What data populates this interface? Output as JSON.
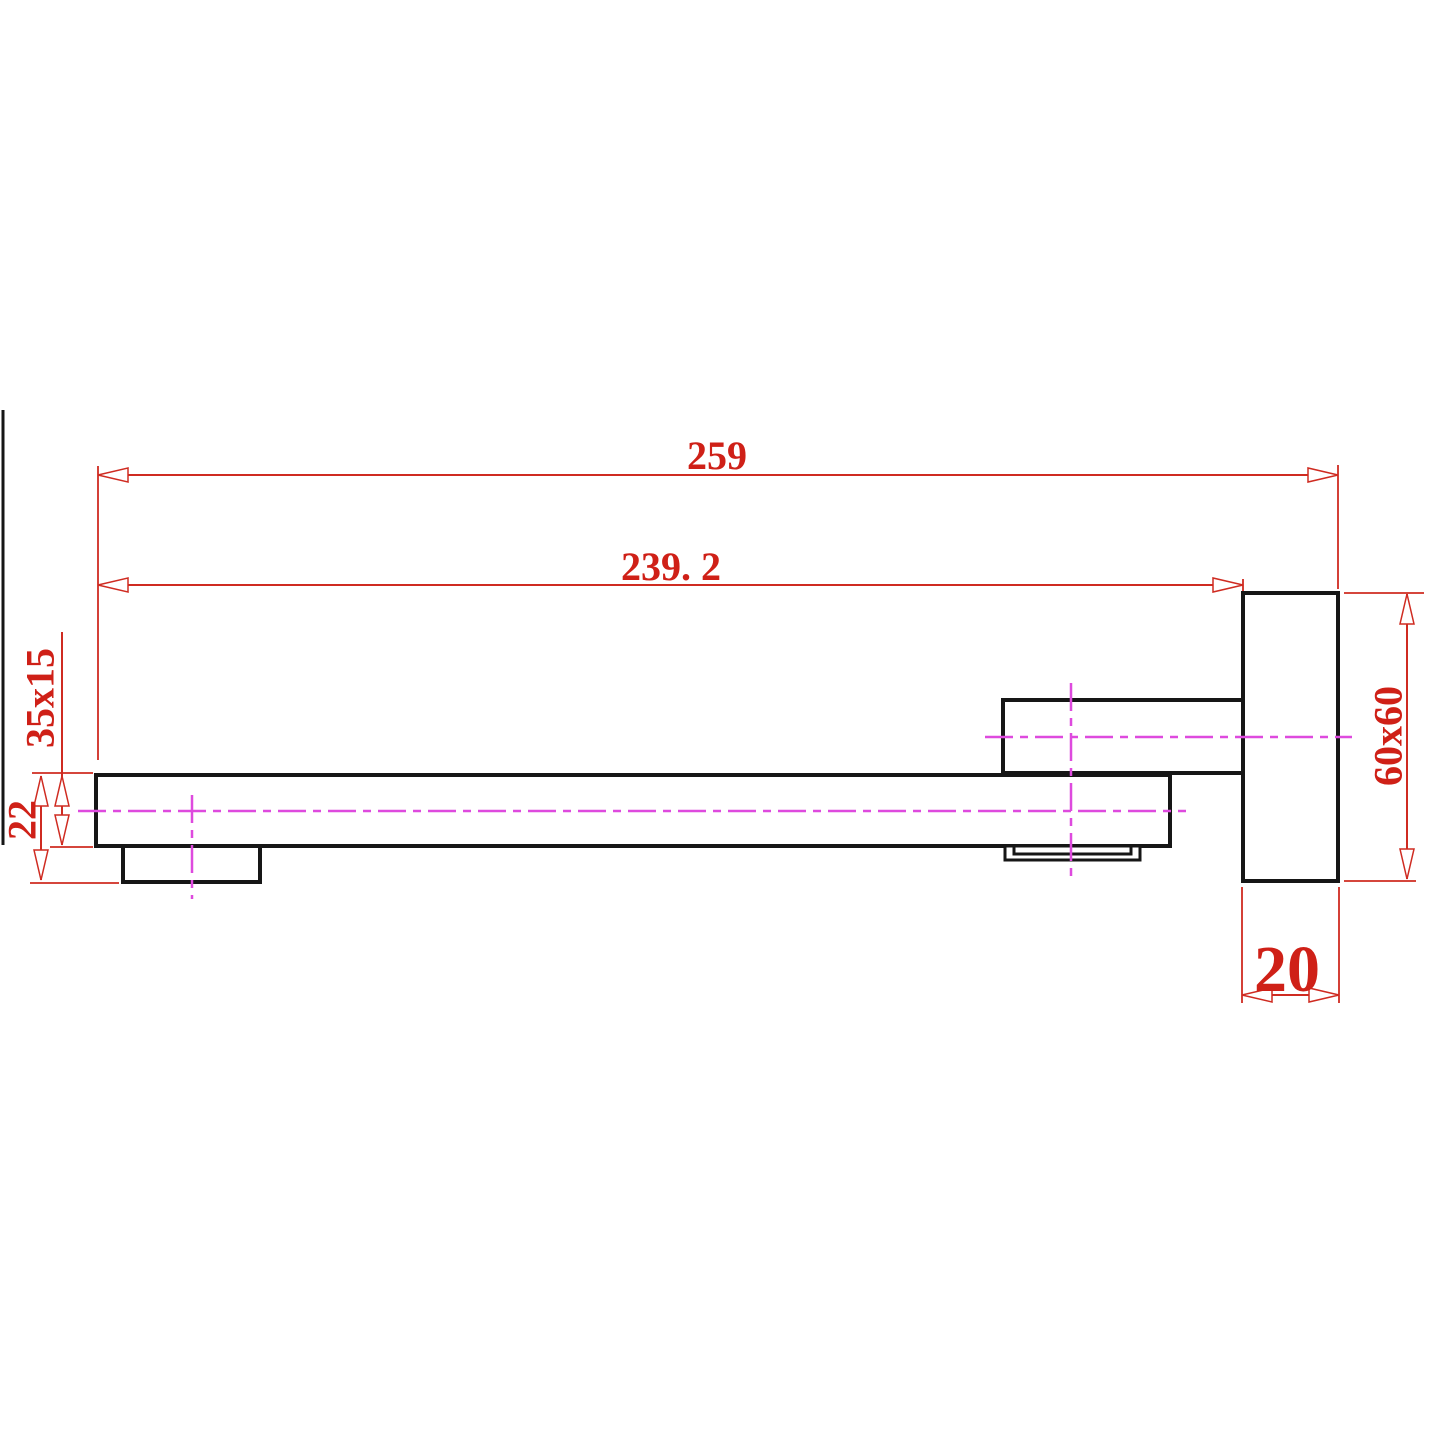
{
  "drawing": {
    "type": "technical-dimension-drawing",
    "subject": "wall-mounted square spout side view",
    "labels": {
      "overall_length": "259",
      "spout_length": "239. 2",
      "arm_section": "35x15",
      "arm_drop": "22",
      "wall_plate": "60x60",
      "plate_depth": "20"
    },
    "colors": {
      "outline": "#161616",
      "dimension": "#cf2b21",
      "dimension_text": "#cf2017",
      "centerline": "#de4ade",
      "background": "#ffffff"
    }
  }
}
